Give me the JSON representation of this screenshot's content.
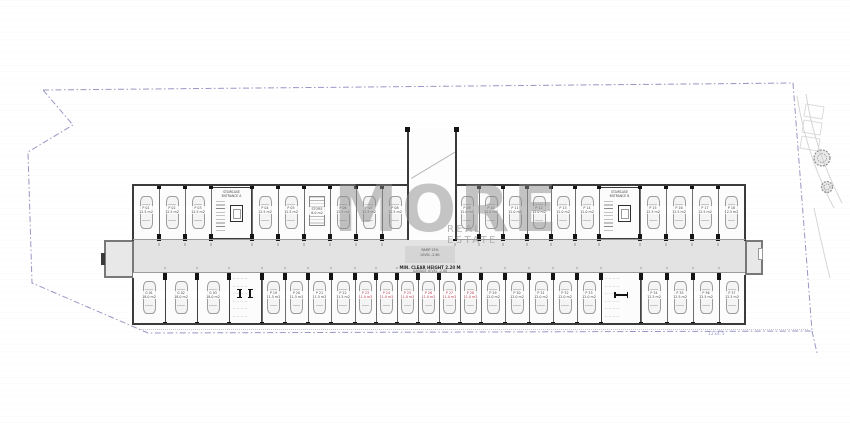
{
  "watermark": {
    "title": "MORE",
    "subtitle": "REAL ESTATE"
  },
  "site": {
    "boundary_color": "#8585bb",
    "boundary_points": [
      [
        43,
        90
      ],
      [
        793,
        83
      ],
      [
        812,
        331
      ],
      [
        148,
        333
      ],
      [
        32,
        283
      ],
      [
        28,
        152
      ],
      [
        73,
        125
      ],
      [
        43,
        90
      ]
    ],
    "boundary_tail": "M812,331 L817,353",
    "road_curves": [
      "M797,96 C803,134 814,170 834,208",
      "M806,94 C812,132 823,166 842,203",
      "M814,208 C819,232 824,254 830,278"
    ],
    "bays": [
      "M806,104 L824,107 L822,119 L804,116 Z",
      "M804,120 L822,123 L820,135 L802,132 Z",
      "M802,136 L820,139 L818,151 L800,148 Z"
    ],
    "trees": [
      {
        "cx": 822,
        "cy": 158,
        "r": 8
      },
      {
        "cx": 827,
        "cy": 187,
        "r": 5.5
      }
    ],
    "dim_label": "1234.5"
  },
  "plan": {
    "colors": {
      "wall": "#3b3b3b",
      "divider": "#6e6e6e",
      "aisle": "#e3e3e3",
      "stall": "#fcfcfc",
      "column": "#141414",
      "red": "#c0394b",
      "front_line": "#9a9a9a"
    },
    "building": {
      "x": 133,
      "y": 184,
      "w": 612,
      "h": 141
    },
    "aisle": {
      "y": 240,
      "h": 32
    },
    "stubs": {
      "left": {
        "x": 104,
        "y": 240,
        "w": 30,
        "h": 38
      },
      "right": {
        "x": 745,
        "y": 240,
        "w": 18,
        "h": 35
      }
    },
    "ramp": {
      "x": 406.5,
      "inner_x": 409,
      "inner_w": 46,
      "top": 128,
      "wall_w": 2.4,
      "landing": {
        "lines": [
          "RAMP 15%",
          "LEVEL -2.80"
        ]
      },
      "note": {
        "lines": [
          "MIN. CLEAR HEIGHT 2.20 M",
          "GARAGE LEVEL -2.80"
        ]
      }
    },
    "rows": {
      "top": {
        "y": 187,
        "h": 52,
        "col_y": 234,
        "tick_y": 185,
        "stalls": [
          {
            "x": 133,
            "w": 26,
            "n": "P 01",
            "a": "12.5 m2"
          },
          {
            "x": 159,
            "w": 26,
            "n": "P 02",
            "a": "12.5 m2"
          },
          {
            "x": 185,
            "w": 26,
            "n": "P 03",
            "a": "12.5 m2"
          },
          {
            "x": 211,
            "w": 41,
            "t": "core",
            "n": "STAIRCASE",
            "a": "ENTRANCE A"
          },
          {
            "x": 252,
            "w": 26,
            "n": "P 04",
            "a": "12.5 m2"
          },
          {
            "x": 278,
            "w": 26,
            "n": "P 05",
            "a": "12.5 m2"
          },
          {
            "x": 304,
            "w": 26,
            "t": "store",
            "n": "STORE",
            "a": "6.0 m2"
          },
          {
            "x": 330,
            "w": 26,
            "n": "P 06",
            "a": "12.5 m2"
          },
          {
            "x": 356,
            "w": 26,
            "n": "P 07",
            "a": "12.5 m2"
          },
          {
            "x": 382,
            "w": 26,
            "n": "P 08",
            "a": "12.5 m2"
          },
          {
            "x": 408,
            "w": 47,
            "t": "gap"
          },
          {
            "x": 455,
            "w": 24,
            "n": "P 09",
            "a": "12.0 m2"
          },
          {
            "x": 479,
            "w": 24,
            "n": "P 10",
            "a": "12.0 m2"
          },
          {
            "x": 503,
            "w": 24,
            "n": "P 11",
            "a": "12.0 m2"
          },
          {
            "x": 527,
            "w": 24,
            "n": "P 12",
            "a": "12.0 m2"
          },
          {
            "x": 551,
            "w": 24,
            "n": "P 13",
            "a": "12.0 m2"
          },
          {
            "x": 575,
            "w": 24,
            "n": "P 14",
            "a": "12.0 m2"
          },
          {
            "x": 599,
            "w": 41,
            "t": "core",
            "n": "STAIRCASE",
            "a": "ENTRANCE B"
          },
          {
            "x": 640,
            "w": 26,
            "n": "P 15",
            "a": "12.5 m2"
          },
          {
            "x": 666,
            "w": 26,
            "n": "P 16",
            "a": "12.5 m2"
          },
          {
            "x": 692,
            "w": 26,
            "n": "P 17",
            "a": "12.5 m2"
          },
          {
            "x": 718,
            "w": 27,
            "n": "P 18",
            "a": "12.5 m2"
          }
        ]
      },
      "bottom": {
        "y": 272,
        "h": 52,
        "col_y": 272.5,
        "tick_y": 321.5,
        "stalls": [
          {
            "x": 133,
            "w": 32,
            "t": "gar",
            "n": "G 01",
            "a": "18.0 m2"
          },
          {
            "x": 165,
            "w": 32,
            "t": "gar",
            "n": "G 02",
            "a": "18.0 m2"
          },
          {
            "x": 197,
            "w": 32,
            "t": "gar",
            "n": "G 03",
            "a": "18.0 m2"
          },
          {
            "x": 229,
            "w": 33,
            "t": "room",
            "sym": "v",
            "lines": [
              "— — — —",
              "— — — —",
              "— — — —",
              "— — — —",
              "— — — —",
              "— — — —"
            ]
          },
          {
            "x": 262,
            "w": 23,
            "n": "P 19",
            "a": "11.5 m2"
          },
          {
            "x": 285,
            "w": 23,
            "n": "P 20",
            "a": "11.5 m2"
          },
          {
            "x": 308,
            "w": 23,
            "n": "P 21",
            "a": "11.5 m2"
          },
          {
            "x": 331,
            "w": 24,
            "n": "P 22",
            "a": "11.5 m2"
          },
          {
            "x": 355,
            "w": 21,
            "red": true,
            "n": "P 23",
            "a": "11.0 m2"
          },
          {
            "x": 376,
            "w": 21,
            "red": true,
            "n": "P 24",
            "a": "11.0 m2"
          },
          {
            "x": 397,
            "w": 21,
            "red": true,
            "n": "P 25",
            "a": "11.0 m2"
          },
          {
            "x": 418,
            "w": 21,
            "red": true,
            "n": "P 26",
            "a": "11.0 m2"
          },
          {
            "x": 439,
            "w": 21,
            "red": true,
            "n": "P 27",
            "a": "11.0 m2"
          },
          {
            "x": 460,
            "w": 21,
            "red": true,
            "n": "P 28",
            "a": "11.0 m2"
          },
          {
            "x": 481,
            "w": 24,
            "n": "P 29",
            "a": "12.0 m2"
          },
          {
            "x": 505,
            "w": 24,
            "n": "P 30",
            "a": "12.0 m2"
          },
          {
            "x": 529,
            "w": 24,
            "n": "P 31",
            "a": "12.0 m2"
          },
          {
            "x": 553,
            "w": 24,
            "n": "P 32",
            "a": "12.0 m2"
          },
          {
            "x": 577,
            "w": 24,
            "n": "P 33",
            "a": "12.0 m2"
          },
          {
            "x": 601,
            "w": 40,
            "t": "room",
            "sym": "h",
            "lines": [
              "— — — —",
              "— — — —",
              "— — — —",
              "— — — —",
              "— — — —",
              "— — — —"
            ]
          },
          {
            "x": 641,
            "w": 26,
            "n": "P 34",
            "a": "12.5 m2"
          },
          {
            "x": 667,
            "w": 26,
            "n": "P 35",
            "a": "12.5 m2"
          },
          {
            "x": 693,
            "w": 26,
            "n": "P 36",
            "a": "12.5 m2"
          },
          {
            "x": 719,
            "w": 26,
            "n": "P 37",
            "a": "12.5 m2"
          }
        ]
      }
    }
  }
}
